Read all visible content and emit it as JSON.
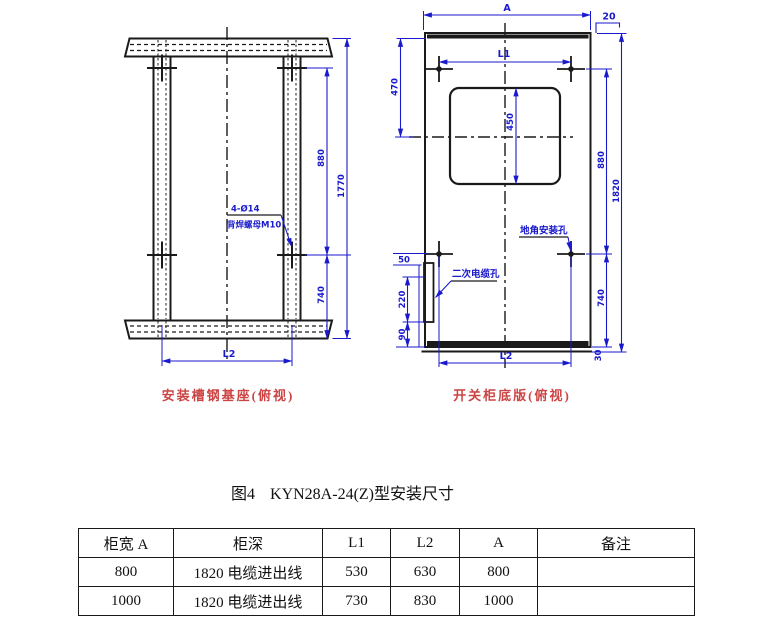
{
  "figure": {
    "prefix": "图4",
    "title": "KYN28A-24(Z)型安装尺寸"
  },
  "left_drawing": {
    "caption": "安装槽钢基座(俯视)",
    "callout": {
      "line1": "4-Ø14",
      "line2": "背焊螺母M10"
    },
    "dims": {
      "d880": "880",
      "d1770": "1770",
      "d740": "740",
      "L2": "L2"
    }
  },
  "right_drawing": {
    "caption": "开关柜底版(俯视)",
    "labels": {
      "anchor_hole": "地角安装孔",
      "secondary_cable_hole": "二次电缆孔"
    },
    "dims": {
      "A": "A",
      "d20": "20",
      "L1": "L1",
      "d470": "470",
      "d450": "450",
      "d880": "880",
      "d1820": "1820",
      "d740": "740",
      "d30": "30",
      "d50": "50",
      "d220": "220",
      "d90": "90",
      "L2": "L2"
    }
  },
  "table": {
    "headers": [
      "柜宽 A",
      "柜深",
      "L1",
      "L2",
      "A",
      "备注"
    ],
    "rows": [
      [
        "800",
        "1820 电缆进出线",
        "530",
        "630",
        "800",
        ""
      ],
      [
        "1000",
        "1820 电缆进出线",
        "730",
        "830",
        "1000",
        ""
      ]
    ]
  },
  "colors": {
    "dimension_blue": "#1a1acd",
    "drawing_black": "#1a1a1a",
    "caption_red": "#cc4444"
  }
}
